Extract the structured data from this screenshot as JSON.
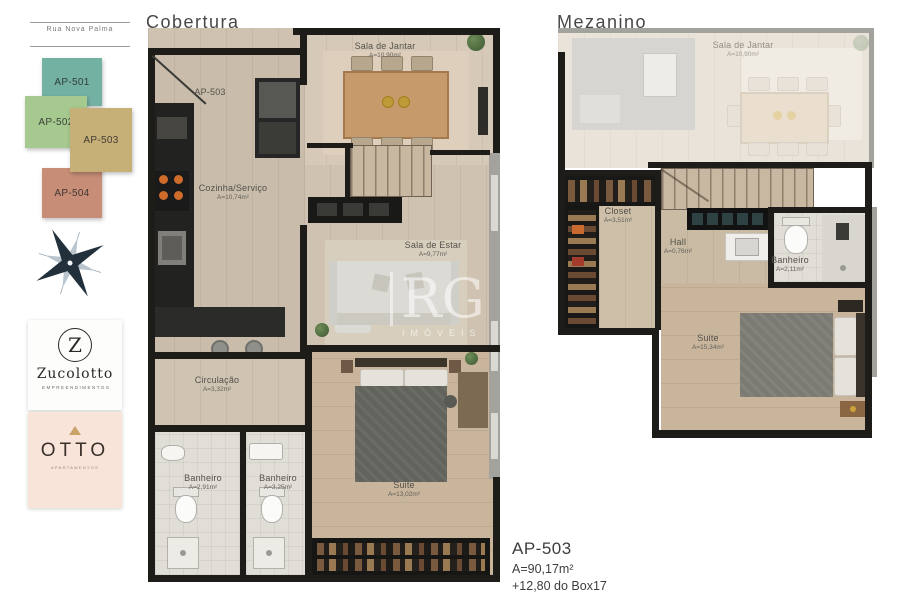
{
  "sheet": {
    "background": "#ffffff"
  },
  "sidebar": {
    "street_label": "Rua Nova Palma",
    "units": [
      {
        "label": "AP-501",
        "color": "#73b1a3"
      },
      {
        "label": "AP-502",
        "color": "#a6c98f"
      },
      {
        "label": "AP-503",
        "color": "#c7b077"
      },
      {
        "label": "AP-504",
        "color": "#c78d77"
      }
    ],
    "compass_icon": "compass-rose",
    "zucolotto": {
      "initial": "Z",
      "name": "Zucolotto",
      "subtitle": "EMPREENDIMENTOS"
    },
    "otto": {
      "name": "OTTO",
      "subtitle": "APARTAMENTOS"
    }
  },
  "cobertura": {
    "title": "Cobertura",
    "entry_label": "AP-503",
    "rooms": {
      "sala_de_jantar": {
        "name": "Sala de Jantar",
        "area": "A=10,90m²"
      },
      "cozinha_servico": {
        "name": "Cozinha/Serviço",
        "area": "A=10,74m²"
      },
      "sala_de_estar": {
        "name": "Sala de Estar",
        "area": "A=9,77m²"
      },
      "circulacao": {
        "name": "Circulação",
        "area": "A=3,32m²"
      },
      "banheiro_1": {
        "name": "Banheiro",
        "area": "A=2,91m²"
      },
      "banheiro_2": {
        "name": "Banheiro",
        "area": "A=3,25m²"
      },
      "suite": {
        "name": "Suite",
        "area": "A=13,02m²"
      }
    }
  },
  "mezanino": {
    "title": "Mezanino",
    "rooms": {
      "sala_de_jantar": {
        "name": "Sala de Jantar",
        "area": "A=10,90m²"
      },
      "closet": {
        "name": "Closet",
        "area": "A=3,51m²"
      },
      "hall": {
        "name": "Hall",
        "area": "A=0,76m²"
      },
      "banheiro": {
        "name": "Banheiro",
        "area": "A=2,11m²"
      },
      "suite": {
        "name": "Suite",
        "area": "A=15,34m²"
      }
    }
  },
  "summary": {
    "unit": "AP-503",
    "area": "A=90,17m²",
    "note": "+12,80 do Box17"
  },
  "watermark": {
    "line1": "RG",
    "line2": "IMÓVEIS"
  }
}
